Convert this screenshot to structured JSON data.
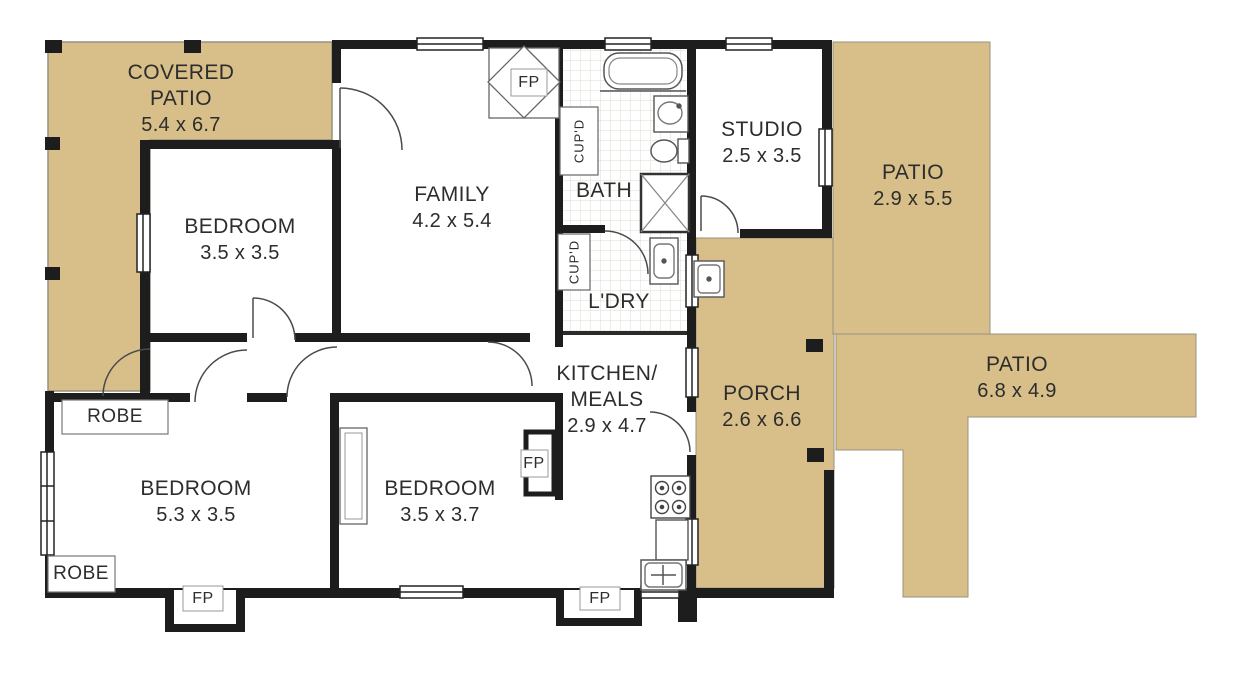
{
  "plan": {
    "rooms": {
      "covered_patio": {
        "name": "COVERED PATIO",
        "dims": "5.4 x 6.7"
      },
      "bedroom_top": {
        "name": "BEDROOM",
        "dims": "3.5 x 3.5"
      },
      "family": {
        "name": "FAMILY",
        "dims": "4.2 x 5.4"
      },
      "bath": {
        "name": "BATH"
      },
      "ldry": {
        "name": "L'DRY"
      },
      "studio": {
        "name": "STUDIO",
        "dims": "2.5 x 3.5"
      },
      "patio_right": {
        "name": "PATIO",
        "dims": "2.9 x 5.5"
      },
      "patio_far": {
        "name": "PATIO",
        "dims": "6.8 x 4.9"
      },
      "porch": {
        "name": "PORCH",
        "dims": "2.6 x 6.6"
      },
      "kitchen": {
        "name": "KITCHEN/ MEALS",
        "dims": "2.9 x 4.7"
      },
      "bedroom_left": {
        "name": "BEDROOM",
        "dims": "5.3 x 3.5"
      },
      "bedroom_mid": {
        "name": "BEDROOM",
        "dims": "3.5 x 3.7"
      }
    },
    "fixtures": {
      "robe": "ROBE",
      "fp": "FP",
      "cupd": "CUP'D"
    },
    "colors": {
      "outdoor_tan": "#d8be88",
      "wall_black": "#1d1d1d",
      "label_text": "#2d2d2d"
    }
  }
}
